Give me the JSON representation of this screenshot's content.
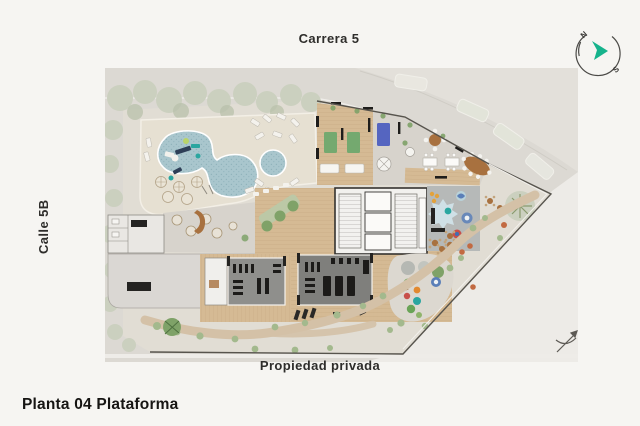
{
  "labels": {
    "street_top": "Carrera 5",
    "street_left": "Calle 5B",
    "street_bottom": "Propiedad privada",
    "title": "Planta 04 Plataforma"
  },
  "compass": {
    "north": "N",
    "south": "S"
  },
  "palette": {
    "paper": "#f6f5f2",
    "street": "#dcd9d3",
    "pale": "#edebe7",
    "ground": "#e1ddd4",
    "deck": "#e6e0d2",
    "water": "#a9c6cd",
    "waterDot": "#8fb2ba",
    "sage": "#cbd0bf",
    "sageDark": "#b9c1ab",
    "green": "#7fa268",
    "bush": "#a3b98d",
    "planter": "#bcc8a6",
    "wood": "#d5ba94",
    "woodDark": "#c3a47c",
    "grayFloor": "#d7d3cc",
    "terrace": "#dad7d3",
    "gym": "#8f8f8c",
    "gymDark": "#7f7f7c",
    "playroom": "#b6b9b8",
    "canopy": "#cfe0e6",
    "path": "#d4c1a7",
    "terracotta": "#c26a42",
    "matGreen": "#74a96f",
    "matBlue": "#5565c0",
    "brown": "#a8713f",
    "ink": "#2e2d2b",
    "wall": "#1e1d1b",
    "teal": "#16b38c",
    "line": "#6b675f"
  },
  "plan": {
    "areas": [
      {
        "name": "swimming-pool",
        "color": "#a9c6cd"
      },
      {
        "name": "kids-pool",
        "color": "#a9c6cd"
      },
      {
        "name": "pool-deck",
        "color": "#e6e0d2"
      },
      {
        "name": "tree-band",
        "color": "#cbd0bf"
      },
      {
        "name": "amenity-wing-wood-floor",
        "color": "#d5ba94"
      },
      {
        "name": "dining-lounge",
        "color": "#d7d3cc"
      },
      {
        "name": "gym-rooms",
        "color": "#8f8f8c"
      },
      {
        "name": "kids-playroom",
        "color": "#b6b9b8"
      },
      {
        "name": "outdoor-playground",
        "color": "#dcd8d0"
      },
      {
        "name": "garden-path",
        "color": "#d4c1a7"
      },
      {
        "name": "street",
        "color": "#dcd9d3"
      },
      {
        "name": "private-property",
        "color": "#edebe7"
      }
    ]
  }
}
